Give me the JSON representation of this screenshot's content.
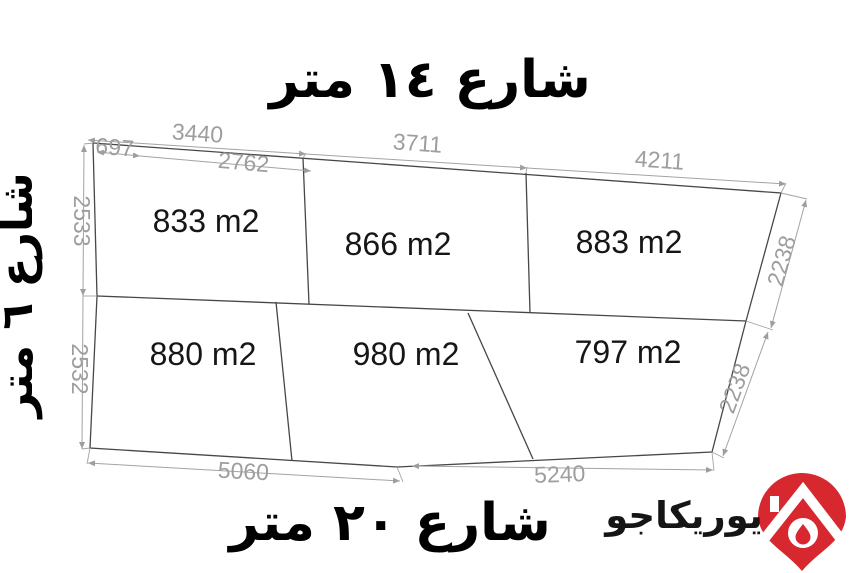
{
  "title": "land-plot-survey-diagram",
  "streets": {
    "top": "شارع ١٤ متر",
    "left": "شارع ٦ متر",
    "bottom": "شارع ٢٠ متر"
  },
  "parcels": [
    {
      "area": "833 m2"
    },
    {
      "area": "866 m2"
    },
    {
      "area": "883 m2"
    },
    {
      "area": "880 m2"
    },
    {
      "area": "980 m2"
    },
    {
      "area": "797 m2"
    }
  ],
  "dims": {
    "top": [
      "3440",
      "3711",
      "4211"
    ],
    "top_sub": [
      "697",
      "2762"
    ],
    "left": [
      "2533",
      "2532"
    ],
    "right": [
      "2238",
      "2238"
    ],
    "bottom": [
      "5060",
      "5240"
    ]
  },
  "logo": {
    "brand": "يوريكاجو",
    "pin_color": "#d7282f"
  }
}
